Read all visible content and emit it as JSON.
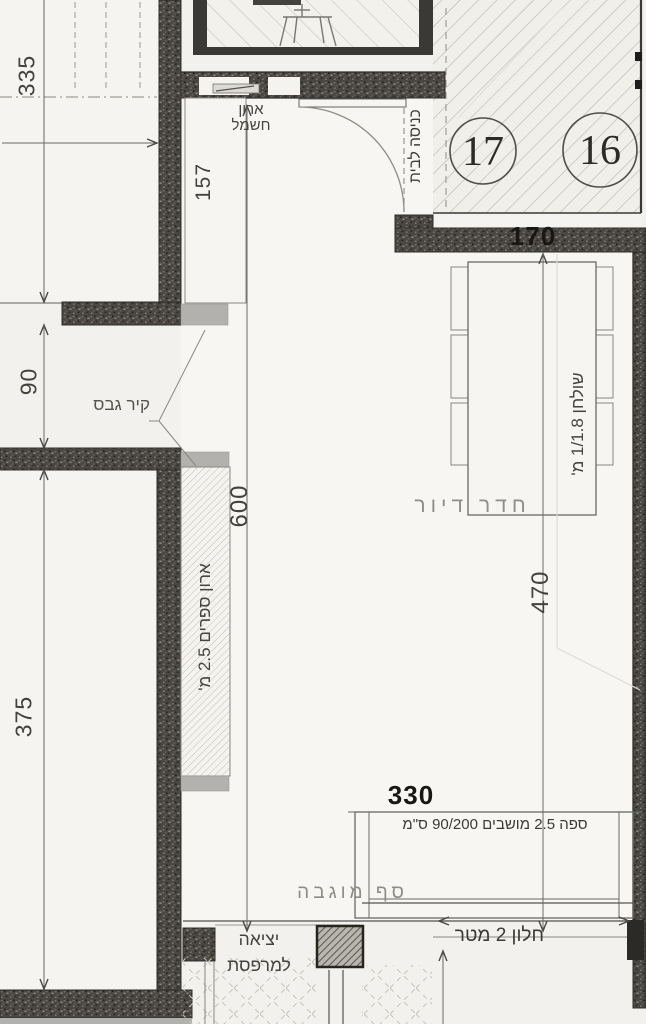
{
  "plan_title": "floor-plan-living-room",
  "rooms": {
    "living_room": "חדר דיור"
  },
  "labels": {
    "electrical_cabinet_line1": "ארון",
    "electrical_cabinet_line2": "חשמל",
    "entrance": "כניסה לבית",
    "gypsum_wall": "קיר גבס",
    "bookcase": "ארון ספרים 2.5 מ'",
    "table": "שולחן 1/1.8 מ'",
    "sofa": "ספה 2.5 מושבים 90/200 ס\"מ",
    "raised_threshold": "סף מוגבה",
    "balcony_exit_line1": "יציאה",
    "balcony_exit_line2": "למרפסת",
    "window": "חלון 2 מטר"
  },
  "dimensions": {
    "upper_left_room": "335",
    "mid_left_gap": "90",
    "lower_left_room": "375",
    "niche": "157",
    "room_width": "600",
    "room_depth": "470",
    "entry_wall": "170",
    "sofa_span": "330"
  },
  "stairs": {
    "step_a": "17",
    "step_b": "16"
  },
  "colors": {
    "paper": "#f2f1ed",
    "room_fill": "#f7f6f3",
    "wall_dark": "#4a4743",
    "gray_fill": "#b3b1ad",
    "line_dark": "#2f2e2b",
    "text_gray": "#908e89",
    "text_black": "#181715"
  }
}
